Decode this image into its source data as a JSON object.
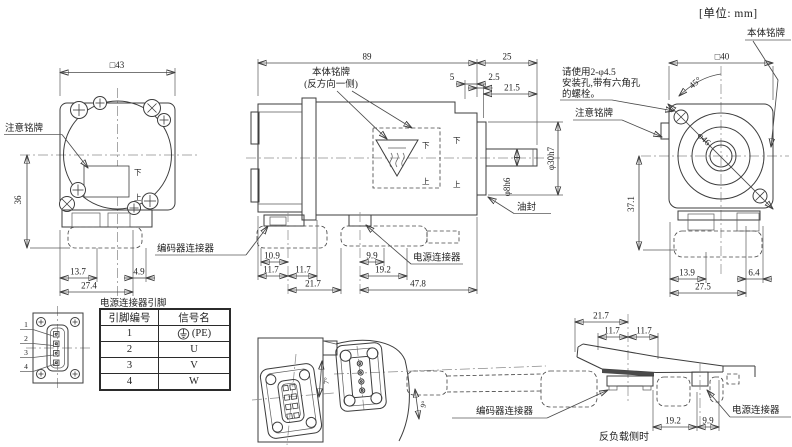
{
  "unit_label": "[单位: mm]",
  "front": {
    "dim_square": "□43",
    "dim_36": "36",
    "dim_13_7": "13.7",
    "dim_4_9": "4.9",
    "dim_27_4": "27.4",
    "caution_label": "注意铭牌",
    "down": "下",
    "up": "上"
  },
  "side": {
    "dim_89": "89",
    "dim_25": "25",
    "dim_5": "5",
    "dim_2_5": "2.5",
    "dim_21_5": "21.5",
    "dim_shaft": "φ8h6",
    "dim_pilot": "φ30h7",
    "dim_10_9": "10.9",
    "dim_11_7": "11.7",
    "dim_21_7": "21.7",
    "dim_9_9": "9.9",
    "dim_19_2": "19.2",
    "dim_47_8": "47.8",
    "nameplate_line1": "本体铭牌",
    "nameplate_line2": "(反方向一侧)",
    "oil_seal": "油封",
    "encoder_connector": "编码器连接器",
    "power_connector": "电源连接器",
    "down": "下",
    "up": "上"
  },
  "rear": {
    "dim_square": "□40",
    "dim_45": "45°",
    "dim_dia46": "φ46",
    "dim_37_1": "37.1",
    "dim_13_9": "13.9",
    "dim_6_4": "6.4",
    "dim_27_5": "27.5",
    "nameplate": "本体铭牌",
    "caution": "注意铭牌",
    "note_line1": "请使用2-φ4.5",
    "note_line2": "安装孔,带有六角孔",
    "note_line3": "的螺栓。"
  },
  "bottom": {
    "angle_7": "7°",
    "angle_9": "9°"
  },
  "rear_side": {
    "dim_21_7": "21.7",
    "dim_11_7": "11.7",
    "dim_19_2": "19.2",
    "dim_9_9": "9.9",
    "encoder_connector": "编码器连接器",
    "power_connector": "电源连接器",
    "caption": "反负载侧时"
  },
  "pin_table": {
    "title": "电源连接器引脚",
    "header_pin": "引脚编号",
    "header_signal": "信号名",
    "rows": [
      {
        "pin": "1",
        "signal": "(PE)"
      },
      {
        "pin": "2",
        "signal": "U"
      },
      {
        "pin": "3",
        "signal": "V"
      },
      {
        "pin": "4",
        "signal": "W"
      }
    ],
    "diagram_pins": [
      "1",
      "2",
      "3",
      "4"
    ]
  }
}
